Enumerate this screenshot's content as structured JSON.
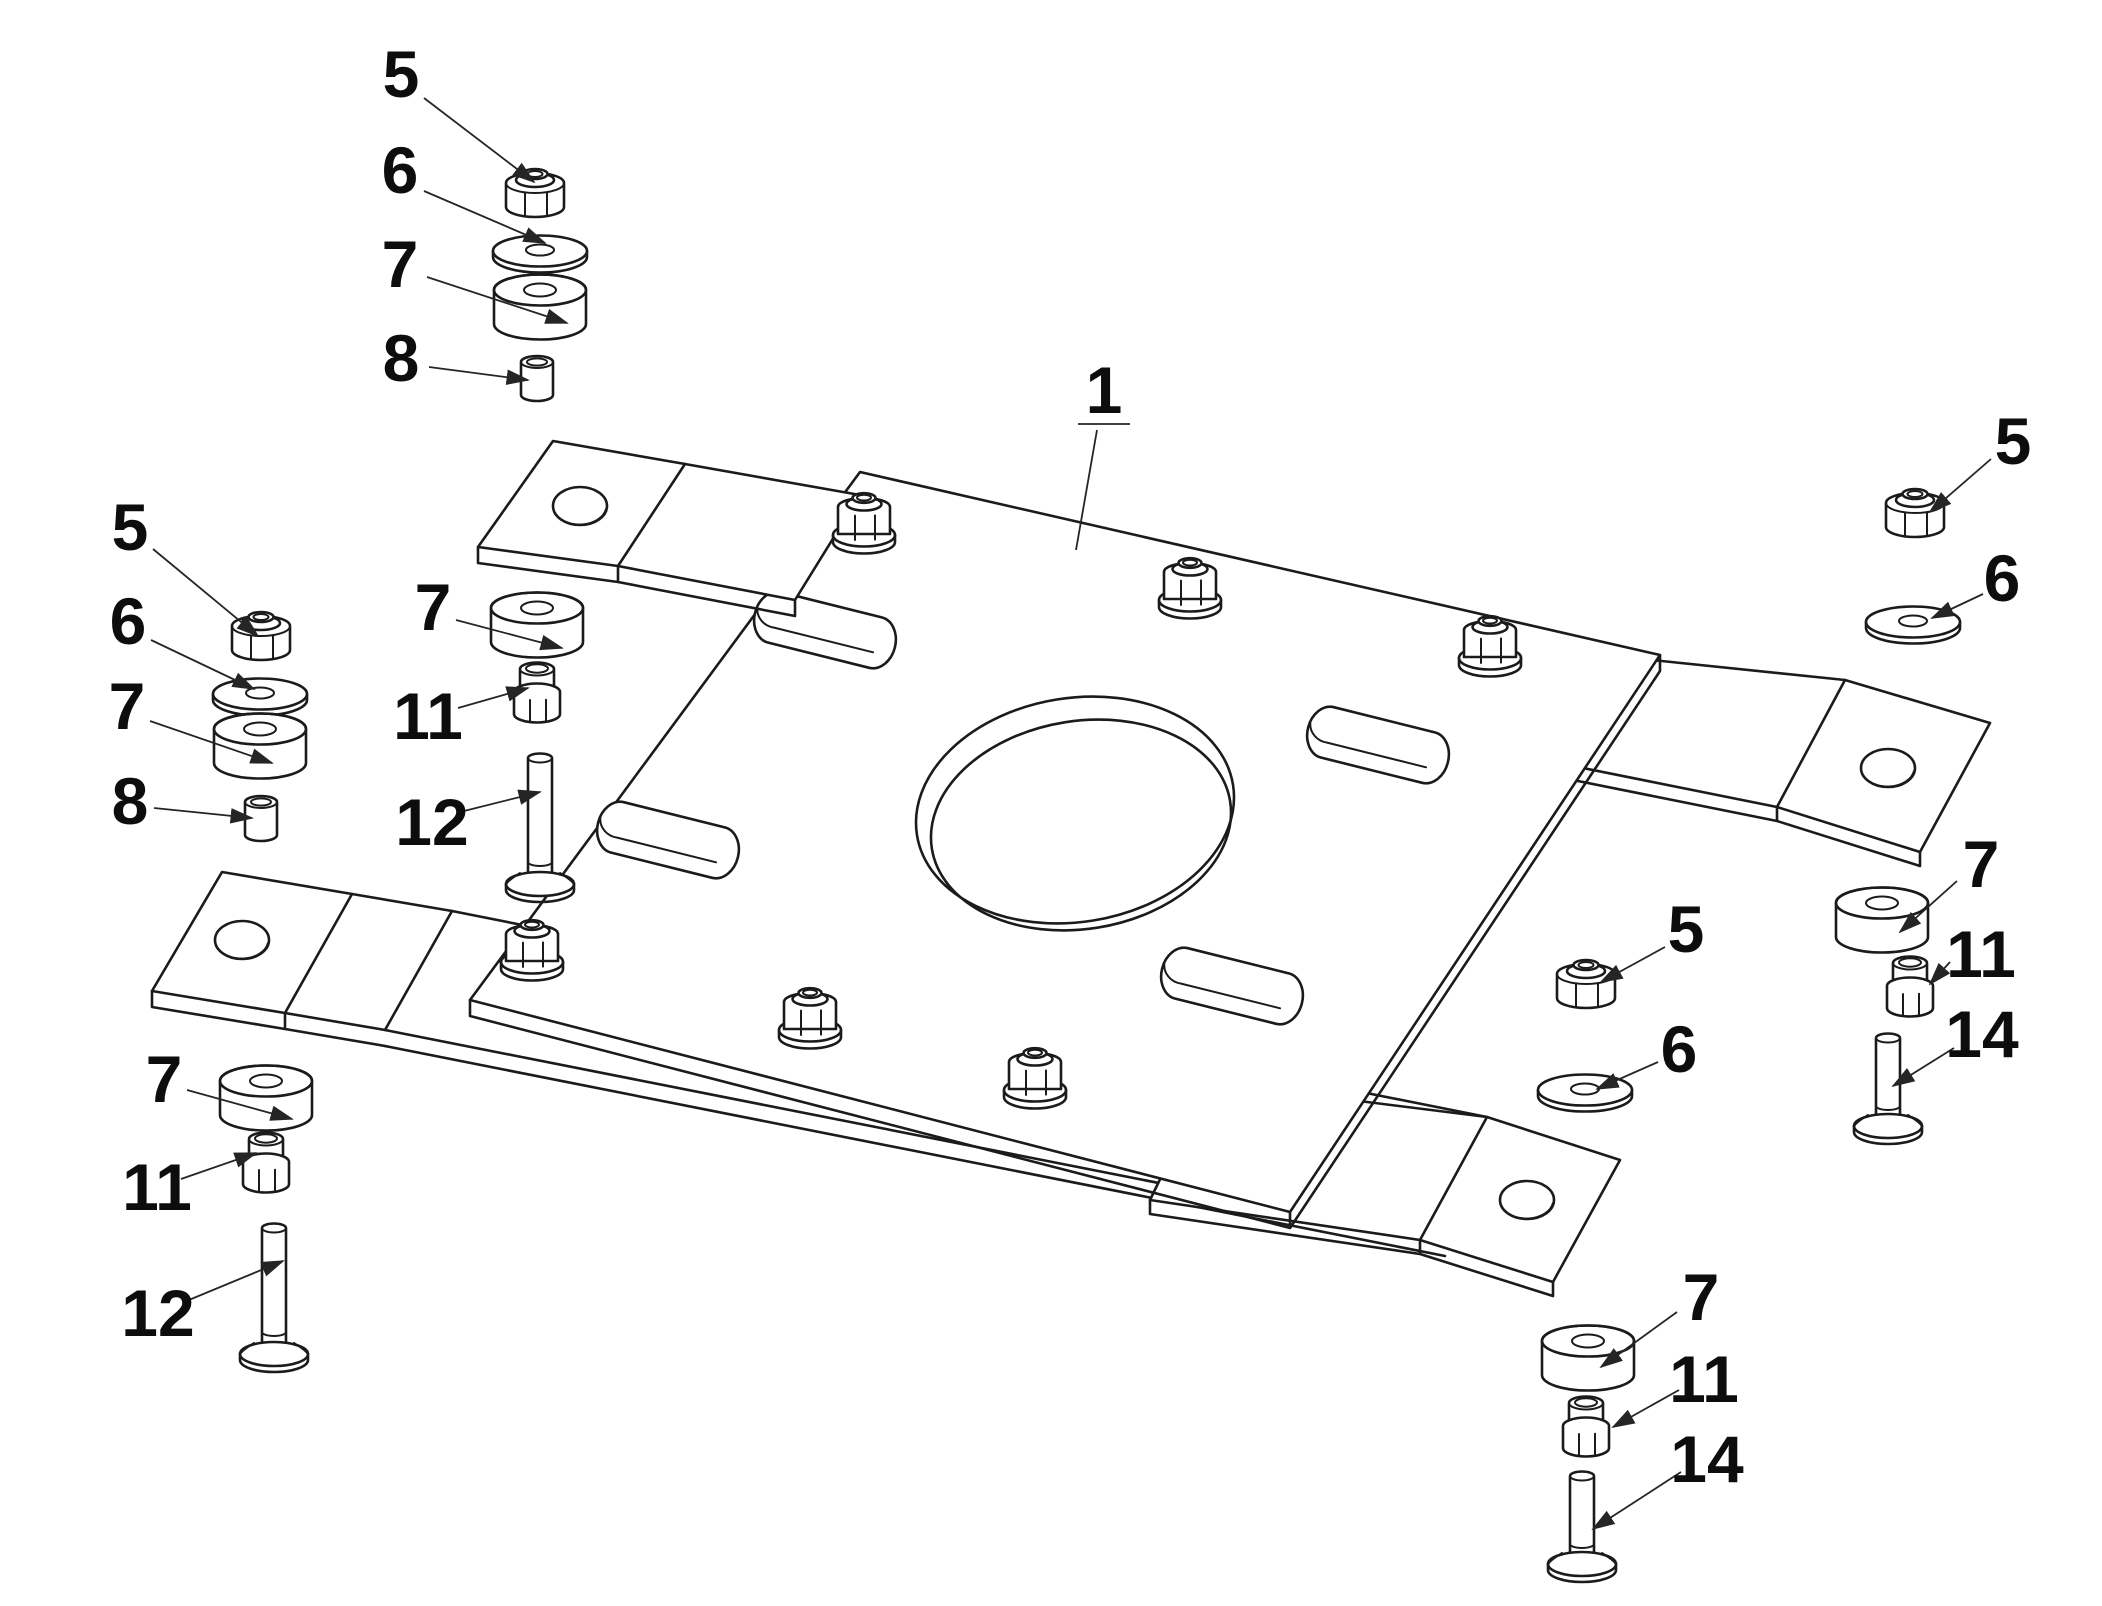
{
  "diagram": {
    "type": "exploded-assembly-technical-drawing",
    "background_color": "#ffffff",
    "line_color": "#1b1b1b",
    "callouts": [
      {
        "label": "1",
        "part": "mounting-plate",
        "x": 1104,
        "y": 390,
        "underline": true,
        "noarrow": true,
        "leader": [
          1097,
          430,
          1076,
          550
        ]
      },
      {
        "label": "5",
        "part": "lock-nut",
        "x": 401,
        "y": 74,
        "leader": [
          424,
          98,
          534,
          182
        ]
      },
      {
        "label": "6",
        "part": "washer",
        "x": 400,
        "y": 170,
        "leader": [
          424,
          191,
          545,
          243
        ]
      },
      {
        "label": "7",
        "part": "spacer",
        "x": 400,
        "y": 264,
        "leader": [
          427,
          277,
          567,
          323
        ]
      },
      {
        "label": "8",
        "part": "sleeve",
        "x": 401,
        "y": 358,
        "leader": [
          429,
          367,
          528,
          380
        ]
      },
      {
        "label": "5",
        "part": "lock-nut",
        "x": 130,
        "y": 527,
        "leader": [
          153,
          549,
          258,
          636
        ]
      },
      {
        "label": "6",
        "part": "washer",
        "x": 128,
        "y": 621,
        "leader": [
          151,
          640,
          254,
          689
        ]
      },
      {
        "label": "7",
        "part": "spacer",
        "x": 127,
        "y": 706,
        "leader": [
          150,
          721,
          272,
          763
        ]
      },
      {
        "label": "8",
        "part": "sleeve",
        "x": 130,
        "y": 801,
        "leader": [
          154,
          808,
          252,
          818
        ]
      },
      {
        "label": "7",
        "part": "spacer",
        "x": 433,
        "y": 607,
        "leader": [
          456,
          620,
          562,
          648
        ]
      },
      {
        "label": "11",
        "part": "flange-nut",
        "x": 428,
        "y": 716,
        "leader": [
          458,
          708,
          528,
          688
        ]
      },
      {
        "label": "12",
        "part": "long-bolt",
        "x": 432,
        "y": 822,
        "leader": [
          460,
          812,
          540,
          792
        ]
      },
      {
        "label": "5",
        "part": "lock-nut",
        "x": 2013,
        "y": 441,
        "leader": [
          1991,
          459,
          1930,
          512
        ]
      },
      {
        "label": "6",
        "part": "washer",
        "x": 2002,
        "y": 578,
        "leader": [
          1983,
          594,
          1932,
          618
        ]
      },
      {
        "label": "5",
        "part": "lock-nut",
        "x": 1686,
        "y": 929,
        "leader": [
          1665,
          947,
          1601,
          982
        ]
      },
      {
        "label": "6",
        "part": "washer",
        "x": 1679,
        "y": 1049,
        "leader": [
          1658,
          1062,
          1597,
          1089
        ]
      },
      {
        "label": "7",
        "part": "spacer",
        "x": 1981,
        "y": 864,
        "leader": [
          1957,
          881,
          1900,
          932
        ]
      },
      {
        "label": "11",
        "part": "flange-nut",
        "x": 1981,
        "y": 954,
        "leader": [
          1950,
          962,
          1930,
          984
        ]
      },
      {
        "label": "14",
        "part": "short-bolt",
        "x": 1982,
        "y": 1034,
        "leader": [
          1954,
          1048,
          1893,
          1086
        ]
      },
      {
        "label": "7",
        "part": "spacer",
        "x": 164,
        "y": 1079,
        "leader": [
          187,
          1090,
          292,
          1119
        ]
      },
      {
        "label": "11",
        "part": "flange-nut",
        "x": 157,
        "y": 1187,
        "leader": [
          181,
          1179,
          256,
          1153
        ]
      },
      {
        "label": "12",
        "part": "long-bolt",
        "x": 158,
        "y": 1313,
        "leader": [
          184,
          1302,
          283,
          1261
        ]
      },
      {
        "label": "7",
        "part": "spacer",
        "x": 1701,
        "y": 1297,
        "leader": [
          1677,
          1312,
          1601,
          1367
        ]
      },
      {
        "label": "11",
        "part": "flange-nut",
        "x": 1704,
        "y": 1379,
        "leader": [
          1679,
          1390,
          1613,
          1427
        ]
      },
      {
        "label": "14",
        "part": "short-bolt",
        "x": 1707,
        "y": 1459,
        "leader": [
          1681,
          1472,
          1593,
          1529
        ]
      }
    ]
  }
}
